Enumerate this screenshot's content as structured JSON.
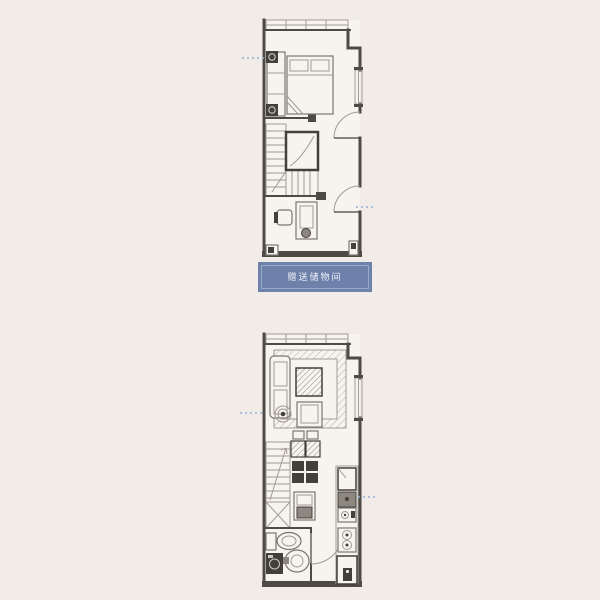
{
  "banner": {
    "label": "赠送储物间"
  },
  "colors": {
    "bg": "#f1ece7",
    "floor": "#f7f4f0",
    "wall": "#4e4a45",
    "line": "#a09a92",
    "furn": "#7a756e",
    "fill-light": "#efebe5",
    "dark": "#43403c",
    "mid": "#8d8780",
    "hatch": "#b7b0a8",
    "banner-bg": "#6e81ab",
    "banner-border": "#9aa9c9",
    "banner-text": "#eef1f7",
    "leader": "#8fb2d6"
  }
}
